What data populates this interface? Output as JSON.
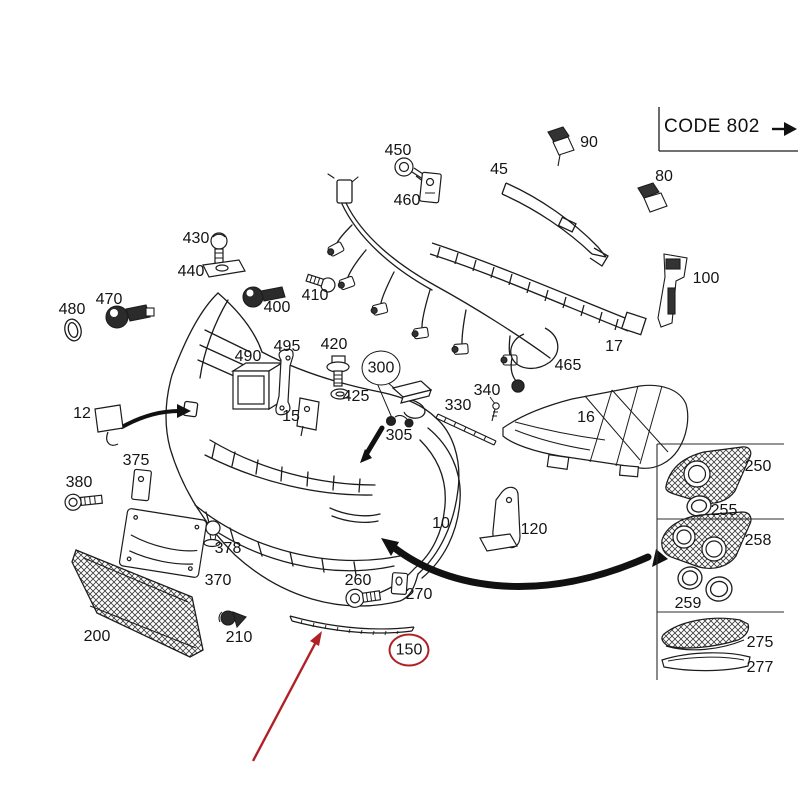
{
  "page": {
    "background": "#ffffff",
    "kind": "exploded parts diagram, front bumper assembly"
  },
  "colors": {
    "line": "#1c1c1c",
    "accent_red": "#b02025",
    "dark_fill": "#2b2b2b"
  },
  "title_block": {
    "code_label": "CODE 802"
  },
  "diagram": {
    "type": "exploded-parts-diagram",
    "highlighted_part": "150",
    "callout_circles": [
      {
        "part": "300",
        "color": "black"
      },
      {
        "part": "150",
        "color": "red"
      }
    ],
    "pointer_arrows": [
      {
        "color": "red",
        "points_to": "trim strip 150"
      },
      {
        "color": "black",
        "points_to": "bumper tow-eye cover location (part 12)"
      },
      {
        "color": "black",
        "points_to": "headlamp washer location (part 300)"
      },
      {
        "color": "black",
        "points_to": "fog grille panel (parts 250-259)"
      }
    ],
    "labels": [
      {
        "text": "450",
        "x": 398,
        "y": 151
      },
      {
        "text": "460",
        "x": 407,
        "y": 201
      },
      {
        "text": "90",
        "x": 589,
        "y": 143
      },
      {
        "text": "45",
        "x": 499,
        "y": 170
      },
      {
        "text": "80",
        "x": 664,
        "y": 177
      },
      {
        "text": "430",
        "x": 196,
        "y": 239
      },
      {
        "text": "440",
        "x": 191,
        "y": 272
      },
      {
        "text": "400",
        "x": 277,
        "y": 308
      },
      {
        "text": "410",
        "x": 315,
        "y": 296
      },
      {
        "text": "470",
        "x": 109,
        "y": 300
      },
      {
        "text": "480",
        "x": 72,
        "y": 310
      },
      {
        "text": "100",
        "x": 706,
        "y": 279
      },
      {
        "text": "17",
        "x": 614,
        "y": 347
      },
      {
        "text": "465",
        "x": 568,
        "y": 366
      },
      {
        "text": "490",
        "x": 248,
        "y": 357
      },
      {
        "text": "495",
        "x": 287,
        "y": 347
      },
      {
        "text": "420",
        "x": 334,
        "y": 345
      },
      {
        "text": "425",
        "x": 356,
        "y": 397
      },
      {
        "text": "300",
        "x": 381,
        "y": 368,
        "ring": "black"
      },
      {
        "text": "305",
        "x": 399,
        "y": 436
      },
      {
        "text": "330",
        "x": 458,
        "y": 406
      },
      {
        "text": "340",
        "x": 487,
        "y": 391
      },
      {
        "text": "16",
        "x": 586,
        "y": 418
      },
      {
        "text": "12",
        "x": 82,
        "y": 414
      },
      {
        "text": "15",
        "x": 291,
        "y": 417
      },
      {
        "text": "375",
        "x": 136,
        "y": 461
      },
      {
        "text": "380",
        "x": 79,
        "y": 483
      },
      {
        "text": "378",
        "x": 228,
        "y": 549
      },
      {
        "text": "370",
        "x": 218,
        "y": 581
      },
      {
        "text": "10",
        "x": 441,
        "y": 524
      },
      {
        "text": "120",
        "x": 534,
        "y": 530
      },
      {
        "text": "200",
        "x": 97,
        "y": 637
      },
      {
        "text": "210",
        "x": 239,
        "y": 638
      },
      {
        "text": "260",
        "x": 358,
        "y": 581
      },
      {
        "text": "270",
        "x": 419,
        "y": 595
      },
      {
        "text": "150",
        "x": 409,
        "y": 650,
        "ring": "red"
      },
      {
        "text": "250",
        "x": 758,
        "y": 467
      },
      {
        "text": "255",
        "x": 724,
        "y": 511
      },
      {
        "text": "258",
        "x": 758,
        "y": 541
      },
      {
        "text": "259",
        "x": 688,
        "y": 604
      },
      {
        "text": "275",
        "x": 760,
        "y": 643
      },
      {
        "text": "277",
        "x": 760,
        "y": 668
      }
    ]
  }
}
